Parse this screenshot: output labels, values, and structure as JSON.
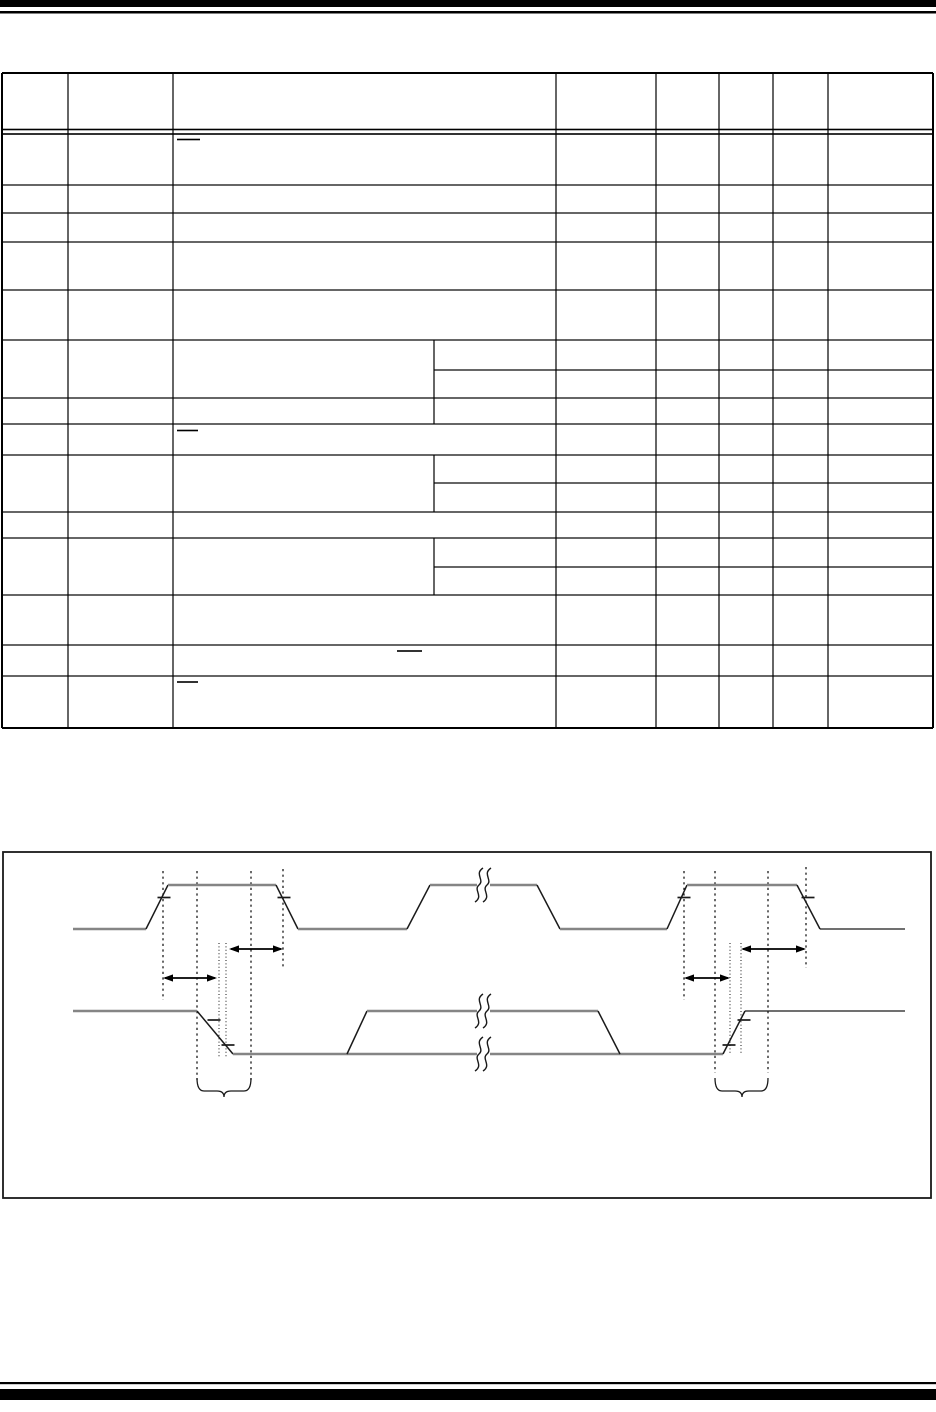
{
  "page": {
    "width": 936,
    "height": 1412,
    "background_color": "#ffffff",
    "ink_color": "#000000",
    "rail_color": "#858585",
    "edge_color": "#1a1a1a",
    "rules": [
      {
        "name": "top-thick-rule",
        "x": 0,
        "y": 0,
        "w": 936,
        "h": 7
      },
      {
        "name": "top-thin-rule",
        "x": 0,
        "y": 11,
        "w": 936,
        "h": 2.5
      },
      {
        "name": "bottom-thin-rule",
        "x": 0,
        "y": 1382,
        "w": 936,
        "h": 2.2
      },
      {
        "name": "bottom-thick-rule",
        "x": 0,
        "y": 1389,
        "w": 936,
        "h": 11
      }
    ]
  },
  "table": {
    "x": 2,
    "y": 73,
    "right": 933,
    "bottom": 728,
    "columns_x": [
      2,
      68,
      173,
      556,
      656,
      719,
      773,
      828,
      933
    ],
    "sub_divider_x": 434,
    "hlines": [
      {
        "y": 73,
        "x1": 2,
        "x2": 933,
        "w": 2
      },
      {
        "y": 129.5,
        "x1": 2,
        "x2": 933,
        "w": 1.6
      },
      {
        "y": 134,
        "x1": 2,
        "x2": 933,
        "w": 1.6
      },
      {
        "y": 185,
        "x1": 2,
        "x2": 933,
        "w": 1.2
      },
      {
        "y": 213,
        "x1": 2,
        "x2": 933,
        "w": 1.2
      },
      {
        "y": 242,
        "x1": 2,
        "x2": 933,
        "w": 1.2
      },
      {
        "y": 290,
        "x1": 2,
        "x2": 933,
        "w": 1.2
      },
      {
        "y": 340,
        "x1": 2,
        "x2": 933,
        "w": 1.2
      },
      {
        "y": 370,
        "x1": 434,
        "x2": 933,
        "w": 1.2
      },
      {
        "y": 398,
        "x1": 2,
        "x2": 933,
        "w": 1.2
      },
      {
        "y": 424,
        "x1": 2,
        "x2": 933,
        "w": 1.2
      },
      {
        "y": 455,
        "x1": 2,
        "x2": 933,
        "w": 1.2
      },
      {
        "y": 483,
        "x1": 434,
        "x2": 933,
        "w": 1.2
      },
      {
        "y": 512,
        "x1": 2,
        "x2": 933,
        "w": 1.2
      },
      {
        "y": 538,
        "x1": 2,
        "x2": 933,
        "w": 1.2
      },
      {
        "y": 567,
        "x1": 434,
        "x2": 933,
        "w": 1.2
      },
      {
        "y": 595,
        "x1": 2,
        "x2": 933,
        "w": 1.2
      },
      {
        "y": 645,
        "x1": 2,
        "x2": 933,
        "w": 1.2
      },
      {
        "y": 676,
        "x1": 2,
        "x2": 933,
        "w": 1.2
      },
      {
        "y": 728,
        "x1": 2,
        "x2": 933,
        "w": 2
      }
    ],
    "vlines": [
      {
        "x": 2,
        "y1": 73,
        "y2": 728,
        "w": 2
      },
      {
        "x": 933,
        "y1": 73,
        "y2": 728,
        "w": 2
      },
      {
        "x": 68,
        "y1": 73,
        "y2": 728,
        "w": 1.2
      },
      {
        "x": 173,
        "y1": 73,
        "y2": 728,
        "w": 1.2
      },
      {
        "x": 556,
        "y1": 73,
        "y2": 728,
        "w": 1.2
      },
      {
        "x": 656,
        "y1": 73,
        "y2": 728,
        "w": 1.2
      },
      {
        "x": 719,
        "y1": 73,
        "y2": 728,
        "w": 1.2
      },
      {
        "x": 773,
        "y1": 73,
        "y2": 728,
        "w": 1.2
      },
      {
        "x": 828,
        "y1": 73,
        "y2": 728,
        "w": 1.2
      },
      {
        "x": 434,
        "y1": 340,
        "y2": 424,
        "w": 1.2
      },
      {
        "x": 434,
        "y1": 455,
        "y2": 512,
        "w": 1.2
      },
      {
        "x": 434,
        "y1": 538,
        "y2": 595,
        "w": 1.2
      }
    ],
    "overline_marks": [
      {
        "x1": 177,
        "x2": 200,
        "y": 139.5,
        "w": 1.6
      },
      {
        "x1": 177,
        "x2": 198,
        "y": 430.5,
        "w": 1.6
      },
      {
        "x1": 397,
        "x2": 422,
        "y": 651,
        "w": 1.6
      },
      {
        "x1": 177,
        "x2": 198,
        "y": 682,
        "w": 1.6
      }
    ]
  },
  "figure": {
    "box": {
      "x": 3,
      "y": 852,
      "w": 928,
      "h": 346,
      "stroke_w": 1.8
    },
    "waveforms": [
      {
        "name": "clock-waveform",
        "segments": [
          {
            "x1": 73,
            "y1": 929,
            "x2": 146,
            "y2": 929,
            "k": "rail"
          },
          {
            "x1": 146,
            "y1": 929,
            "x2": 168,
            "y2": 885,
            "k": "edge"
          },
          {
            "x1": 168,
            "y1": 885,
            "x2": 276,
            "y2": 885,
            "k": "rail"
          },
          {
            "x1": 276,
            "y1": 885,
            "x2": 298,
            "y2": 929,
            "k": "edge"
          },
          {
            "x1": 298,
            "y1": 929,
            "x2": 407,
            "y2": 929,
            "k": "rail"
          },
          {
            "x1": 407,
            "y1": 929,
            "x2": 430,
            "y2": 885,
            "k": "edge"
          },
          {
            "x1": 430,
            "y1": 885,
            "x2": 477,
            "y2": 885,
            "k": "rail"
          },
          {
            "x1": 490,
            "y1": 885,
            "x2": 537,
            "y2": 885,
            "k": "rail"
          },
          {
            "x1": 537,
            "y1": 885,
            "x2": 560,
            "y2": 929,
            "k": "edge"
          },
          {
            "x1": 560,
            "y1": 929,
            "x2": 667,
            "y2": 929,
            "k": "rail"
          },
          {
            "x1": 667,
            "y1": 929,
            "x2": 687,
            "y2": 885,
            "k": "edge"
          },
          {
            "x1": 687,
            "y1": 885,
            "x2": 797,
            "y2": 885,
            "k": "rail"
          },
          {
            "x1": 797,
            "y1": 885,
            "x2": 820,
            "y2": 929,
            "k": "edge"
          },
          {
            "x1": 820,
            "y1": 929,
            "x2": 905,
            "y2": 929,
            "k": "tail"
          }
        ]
      },
      {
        "name": "data-waveform",
        "segments": [
          {
            "x1": 73,
            "y1": 1011,
            "x2": 197,
            "y2": 1011,
            "k": "rail"
          },
          {
            "x1": 197,
            "y1": 1011,
            "x2": 233,
            "y2": 1054,
            "k": "edge"
          },
          {
            "x1": 233,
            "y1": 1054,
            "x2": 477,
            "y2": 1054,
            "k": "rail"
          },
          {
            "x1": 490,
            "y1": 1054,
            "x2": 723,
            "y2": 1054,
            "k": "rail"
          },
          {
            "x1": 347,
            "y1": 1054,
            "x2": 367,
            "y2": 1011,
            "k": "edge"
          },
          {
            "x1": 367,
            "y1": 1011,
            "x2": 477,
            "y2": 1011,
            "k": "rail"
          },
          {
            "x1": 490,
            "y1": 1011,
            "x2": 598,
            "y2": 1011,
            "k": "rail"
          },
          {
            "x1": 598,
            "y1": 1011,
            "x2": 620,
            "y2": 1054,
            "k": "edge"
          },
          {
            "x1": 723,
            "y1": 1054,
            "x2": 745,
            "y2": 1011,
            "k": "edge"
          },
          {
            "x1": 745,
            "y1": 1011,
            "x2": 905,
            "y2": 1011,
            "k": "tail"
          }
        ]
      }
    ],
    "breaks": [
      {
        "x": 483,
        "cy": 885
      },
      {
        "x": 483,
        "cy": 1011
      },
      {
        "x": 483,
        "cy": 1054
      }
    ],
    "dashed_lines": [
      {
        "x": 163,
        "y1": 871,
        "y2": 1000
      },
      {
        "x": 197,
        "y1": 871,
        "y2": 1080
      },
      {
        "x": 251,
        "y1": 871,
        "y2": 1080
      },
      {
        "x": 283,
        "y1": 869,
        "y2": 968
      },
      {
        "x": 684,
        "y1": 871,
        "y2": 1000
      },
      {
        "x": 715,
        "y1": 871,
        "y2": 1073
      },
      {
        "x": 768,
        "y1": 871,
        "y2": 1073
      },
      {
        "x": 806,
        "y1": 867,
        "y2": 968
      }
    ],
    "dotted_lines": [
      {
        "x": 219,
        "y1": 943,
        "y2": 1058
      },
      {
        "x": 226,
        "y1": 943,
        "y2": 1058
      },
      {
        "x": 730,
        "y1": 943,
        "y2": 1053
      },
      {
        "x": 741,
        "y1": 943,
        "y2": 1053
      }
    ],
    "arrows": [
      {
        "x1": 163,
        "x2": 217,
        "y": 978
      },
      {
        "x1": 229,
        "x2": 283,
        "y": 949
      },
      {
        "x1": 684,
        "x2": 730,
        "y": 978
      },
      {
        "x1": 741,
        "x2": 806,
        "y": 949
      }
    ],
    "edge_ticks": [
      {
        "cx": 164,
        "y": 897.5
      },
      {
        "cx": 284,
        "y": 897.5
      },
      {
        "cx": 684,
        "y": 897.5
      },
      {
        "cx": 808,
        "y": 897.5
      },
      {
        "cx": 214,
        "y": 1020
      },
      {
        "cx": 228,
        "y": 1045
      },
      {
        "cx": 729,
        "y": 1045
      },
      {
        "cx": 744,
        "y": 1020
      }
    ],
    "braces": [
      {
        "x1": 197,
        "x2": 251,
        "tip": 224,
        "y_top": 1078,
        "y_body": 1091,
        "tip_drop": 6
      },
      {
        "x1": 715,
        "x2": 768,
        "tip": 742,
        "y_top": 1078,
        "y_body": 1091,
        "tip_drop": 6
      }
    ]
  }
}
